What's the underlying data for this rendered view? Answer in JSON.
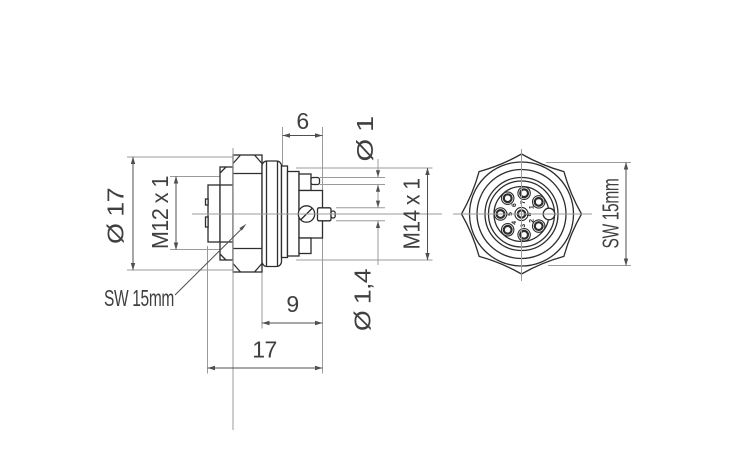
{
  "drawing": {
    "background": "#ffffff",
    "colors": {
      "object_line": "#2d2d2d",
      "dimension_line": "#4f4f4f",
      "extension_line": "#9b9b9b",
      "text": "#3f3f3f"
    },
    "side_view": {
      "dimensions": {
        "dia17": {
          "label": "Ø 17"
        },
        "m12": {
          "label": "M12 x 1"
        },
        "len6": {
          "label": "6"
        },
        "dia1": {
          "label": "Ø 1"
        },
        "m14": {
          "label": "M14 x 1"
        },
        "len9": {
          "label": "9"
        },
        "dia1_4": {
          "label": "Ø 1,4"
        },
        "len17": {
          "label": "17"
        }
      },
      "leader_sw": {
        "label": "SW 15mm"
      }
    },
    "front_view": {
      "dimension_sw": {
        "label": "SW 15mm"
      },
      "pins": [
        {
          "number": "1"
        },
        {
          "number": "2"
        },
        {
          "number": "3"
        },
        {
          "number": "4"
        },
        {
          "number": "5"
        },
        {
          "number": "6"
        },
        {
          "number": "7"
        },
        {
          "number": "8"
        }
      ]
    }
  }
}
